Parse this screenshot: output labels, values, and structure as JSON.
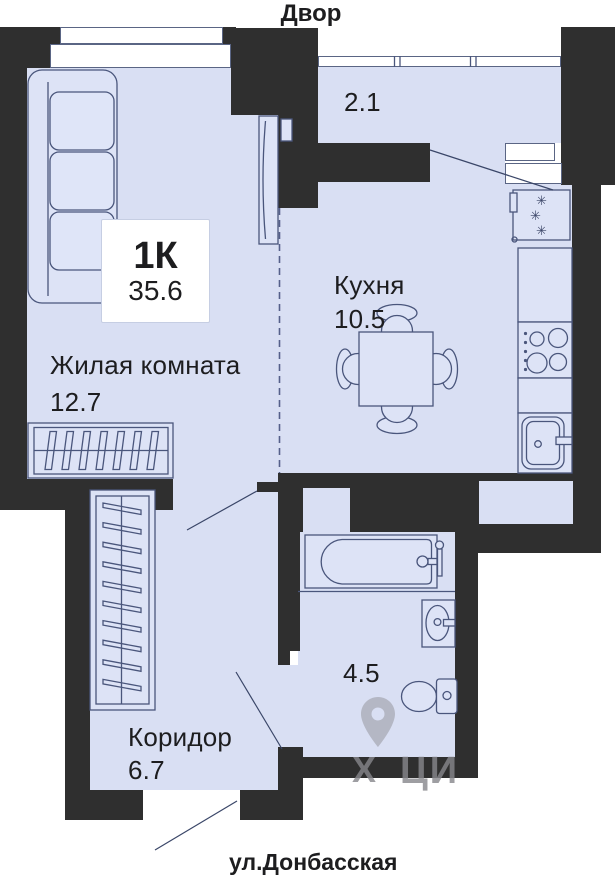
{
  "title": {
    "top": "Двор",
    "bottom": "ул.Донбасская"
  },
  "unit": {
    "type": "1К",
    "total_area": "35.6"
  },
  "rooms": {
    "living": {
      "name": "Жилая комната",
      "area": "12.7"
    },
    "kitchen": {
      "name": "Кухня",
      "area": "10.5"
    },
    "corridor": {
      "name": "Коридор",
      "area": "6.7"
    },
    "bathroom": {
      "area": "4.5"
    },
    "balcony": {
      "area": "2.1"
    }
  },
  "icons": {
    "fridge_snowflake": "✳"
  },
  "watermark": {
    "mark": "Х",
    "text": "ЦИ"
  },
  "colors": {
    "wall": "#2f2f2f",
    "floor": "#d9dff3",
    "line": "#4a567c",
    "text": "#1d1d1f",
    "background": "#ffffff"
  }
}
